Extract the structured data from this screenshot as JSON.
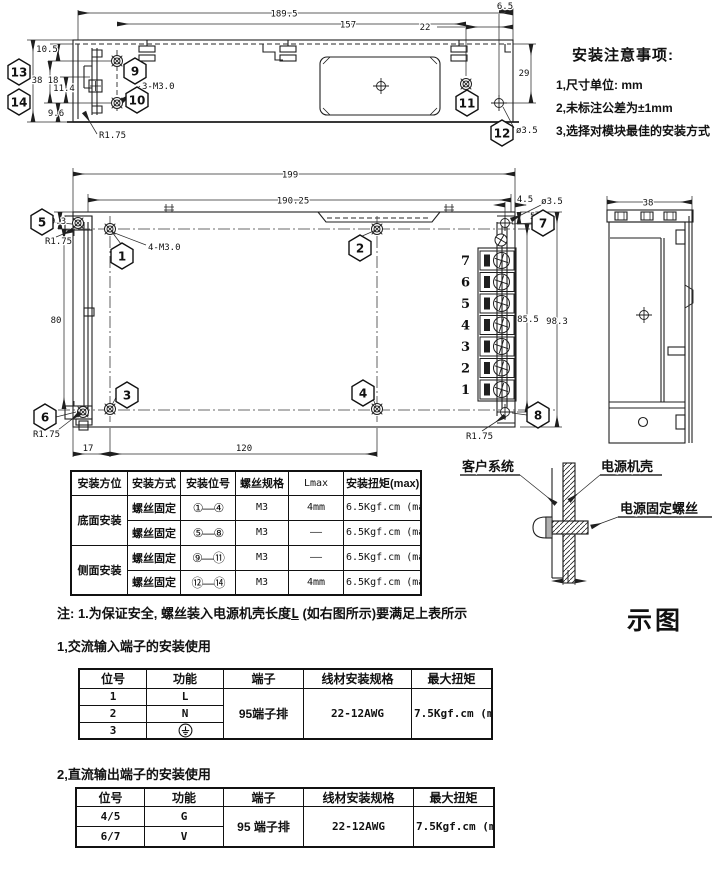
{
  "notes": {
    "title": "安装注意事项:",
    "item1": "1,尺寸单位: mm",
    "item2": "2,未标注公差为±1mm",
    "item3": "3,选择对模块最佳的安装方式"
  },
  "side_view": {
    "d1895": "189.5",
    "d157": "157",
    "d22": "22",
    "d65": "6.5",
    "d29": "29",
    "d105": "10.5",
    "d38": "38",
    "d18": "18",
    "d114": "11.4",
    "d96": "9.6",
    "r175": "R1.75",
    "thread": "3-M3.0",
    "hole": "ø3.5",
    "b9": "9",
    "b10": "10",
    "b11": "11",
    "b12": "12",
    "b13": "13",
    "b14": "14"
  },
  "top_view": {
    "d199": "199",
    "d19025": "190.25",
    "d45": "4.5",
    "hole": "ø3.5",
    "d58": "5.8",
    "d93": "9.3",
    "r175": "R1.75",
    "thread": "4-M3.0",
    "d80": "80",
    "d17": "17",
    "d120": "120",
    "d855": "85.5",
    "d983": "98.3",
    "b1": "1",
    "b2": "2",
    "b3": "3",
    "b4": "4",
    "b5": "5",
    "b6": "6",
    "b7": "7",
    "b8": "8",
    "t7": "7",
    "t6": "6",
    "t5": "5",
    "t4": "4",
    "t3": "3",
    "t2": "2",
    "t1": "1"
  },
  "end_view": {
    "d38": "38"
  },
  "mount_table": {
    "headers": {
      "h1": "安装方位",
      "h2": "安装方式",
      "h3": "安装位号",
      "h4": "螺丝规格",
      "h5": "Lmax",
      "h6": "安装扭矩(max)"
    },
    "row1": {
      "pos": "底面安装",
      "method": "螺丝固定",
      "loc": "①—④",
      "screw": "M3",
      "lmax": "4mm",
      "torque": "6.5Kgf.cm (max)"
    },
    "row2": {
      "method": "螺丝固定",
      "loc": "⑤—⑧",
      "screw": "M3",
      "lmax": "——",
      "torque": "6.5Kgf.cm (max)"
    },
    "row3": {
      "pos": "侧面安装",
      "method": "螺丝固定",
      "loc": "⑨—⑪",
      "screw": "M3",
      "lmax": "——",
      "torque": "6.5Kgf.cm (max)"
    },
    "row4": {
      "method": "螺丝固定",
      "loc": "⑫—⑭",
      "screw": "M3",
      "lmax": "4mm",
      "torque": "6.5Kgf.cm (max)"
    }
  },
  "illustration": {
    "customer": "客户系统",
    "case": "电源机壳",
    "screw": "电源固定螺丝",
    "caption": "示图"
  },
  "note_line": {
    "prefix": "注: 1.为保证安全, 螺丝装入电源机壳长度",
    "l": "L",
    "suffix": " (如右图所示)要满足上表所示"
  },
  "ac_section": {
    "heading": "1,交流输入端子的安装使用",
    "headers": {
      "h1": "位号",
      "h2": "功能",
      "h3": "端子",
      "h4": "线材安装规格",
      "h5": "最大扭矩"
    },
    "r1pos": "1",
    "r1fn": "L",
    "r2pos": "2",
    "r2fn": "N",
    "r3pos": "3",
    "r3fn_icon": "protective-earth",
    "terminal": "95端子排",
    "wire": "22-12AWG",
    "torque": "7.5Kgf.cm (max)"
  },
  "dc_section": {
    "heading": "2,直流输出端子的安装使用",
    "headers": {
      "h1": "位号",
      "h2": "功能",
      "h3": "端子",
      "h4": "线材安装规格",
      "h5": "最大扭矩"
    },
    "r1pos": "4/5",
    "r1fn": "G",
    "r2pos": "6/7",
    "r2fn": "V",
    "terminal": "95 端子排",
    "wire": "22-12AWG",
    "torque": "7.5Kgf.cm (max)"
  }
}
